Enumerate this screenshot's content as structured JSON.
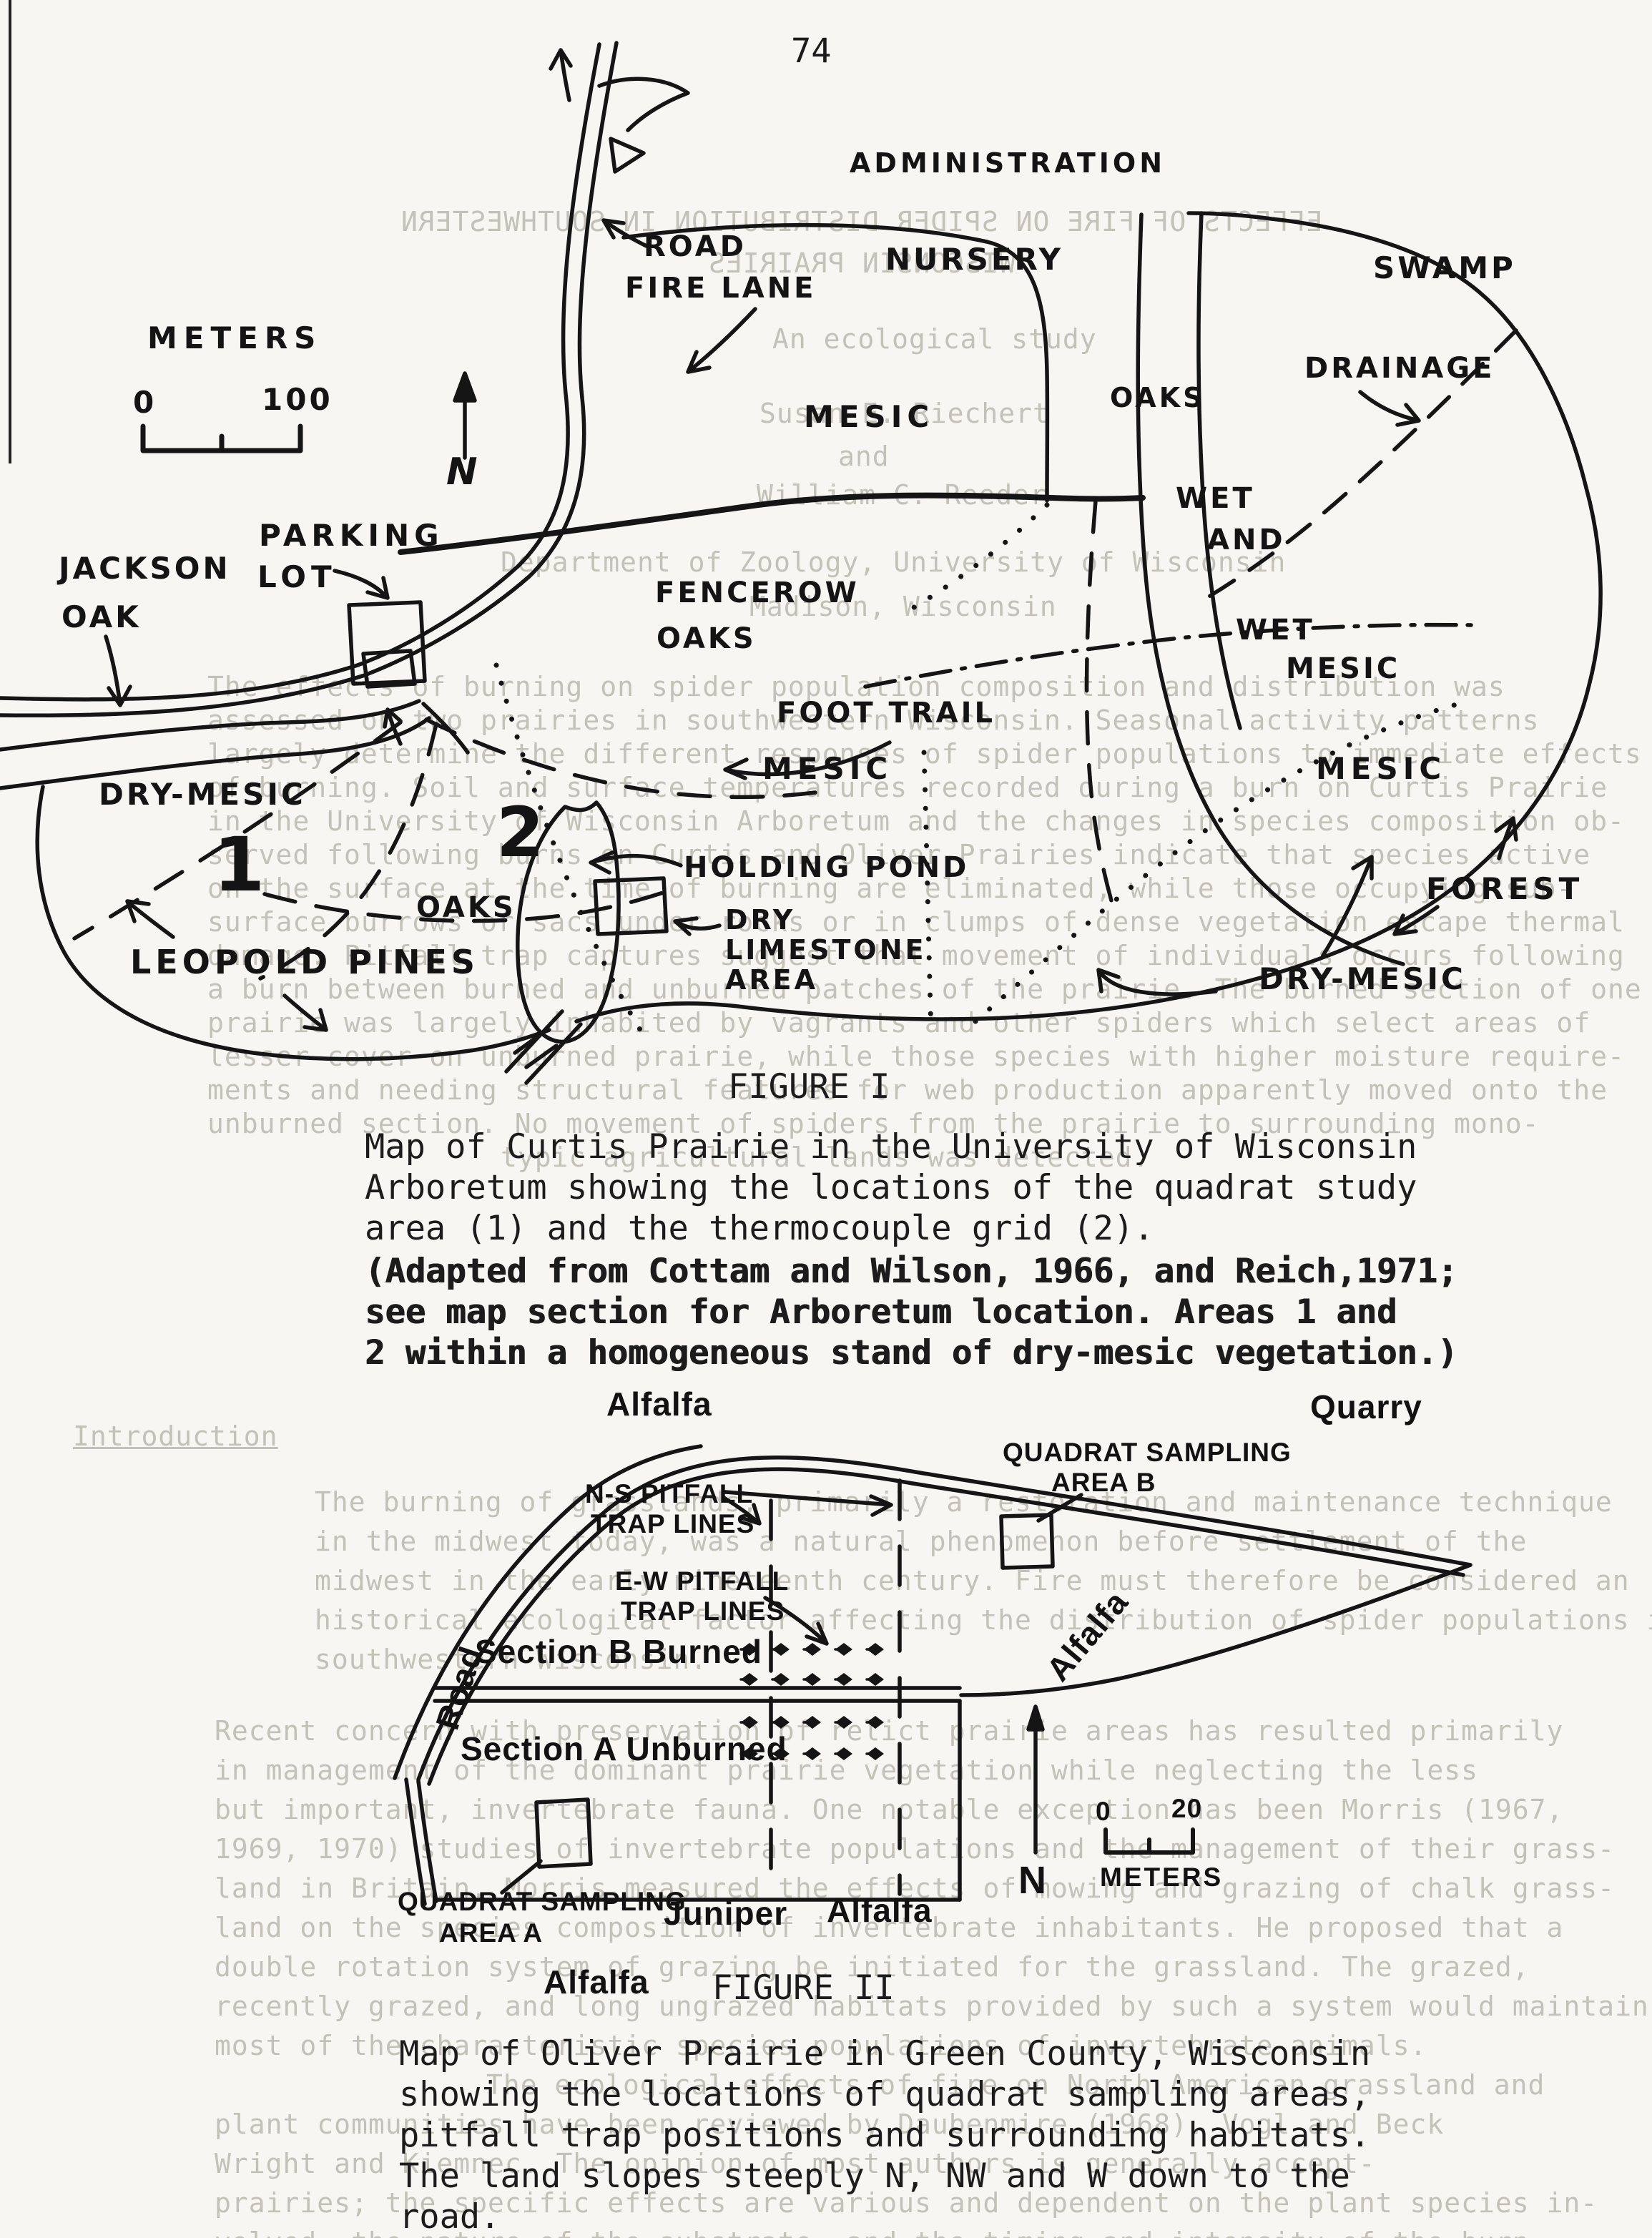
{
  "page": {
    "number": "74"
  },
  "figure1": {
    "heading": "FIGURE I",
    "caption": [
      "Map of Curtis Prairie in the University of Wisconsin",
      "Arboretum showing the locations of the quadrat study",
      "area (1) and the thermocouple grid (2)."
    ],
    "caption_adapted": [
      "(Adapted from Cottam and Wilson, 1966, and Reich,1971;",
      "see map section for Arboretum location. Areas 1 and",
      "2 within a homogeneous stand of dry-mesic vegetation.)"
    ],
    "scale": {
      "title": "METERS",
      "zero": "0",
      "hundred": "100"
    },
    "north": "N",
    "labels": {
      "road": "ROAD",
      "fire_lane": "FIRE LANE",
      "administration": "ADMINISTRATION",
      "nursery": "NURSERY",
      "swamp": "SWAMP",
      "drainage": "DRAINAGE",
      "oaks_top": "OAKS",
      "mesic_top": "MESIC",
      "wet1": "WET",
      "and": "AND",
      "wet2": "WET",
      "mesic_wet": "MESIC",
      "jackson": "JACKSON",
      "jackson_oak": "OAK",
      "parking": "PARKING",
      "parking_lot": "LOT",
      "fencerow": "FENCEROW",
      "fencerow_oaks": "OAKS",
      "foot_trail": "FOOT TRAIL",
      "dry_mesic_left": "DRY-MESIC",
      "area1": "1",
      "area2": "2",
      "mesic_center": "MESIC",
      "mesic_right": "MESIC",
      "holding_pond": "HOLDING POND",
      "oaks_center": "OAKS",
      "dry": "DRY",
      "limestone": "LIMESTONE",
      "area_word": "AREA",
      "leopold_pines": "LEOPOLD PINES",
      "forest": "FOREST",
      "dry_mesic_right": "DRY-MESIC"
    }
  },
  "figure2": {
    "heading": "FIGURE II",
    "caption": [
      "Map of Oliver Prairie in Green County, Wisconsin",
      "showing the locations of quadrat sampling areas,",
      "pitfall trap positions and surrounding habitats.",
      "The land slopes steeply N, NW and W down to the",
      "road."
    ],
    "scale": {
      "zero": "0",
      "twenty": "20",
      "units": "METERS"
    },
    "north": "N",
    "labels": {
      "alfalfa_top": "Alfalfa",
      "quarry": "Quarry",
      "quadrat_b1": "QUADRAT SAMPLING",
      "quadrat_b2": "AREA B",
      "ns_pitfall1": "N-S PITFALL",
      "ns_pitfall2": "TRAP LINES",
      "ew_pitfall1": "E-W PITFALL",
      "ew_pitfall2": "TRAP LINES",
      "road": "Road",
      "section_b": "Section B Burned",
      "section_a": "Section A Unburned",
      "alfalfa_right": "Alfalfa",
      "quadrat_a1": "QUADRAT SAMPLING",
      "quadrat_a2": "AREA A",
      "juniper": "Juniper",
      "alfalfa_mid": "Alfalfa",
      "alfalfa_bottom": "Alfalfa"
    }
  },
  "bleed": {
    "lines": [
      "EFFECTS OF FIRE ON SPIDER DISTRIBUTION IN SOUTHWESTERN",
      "WISCONSIN PRAIRIES",
      "An ecological study",
      "Susan E. Riechert",
      "and",
      "William C. Reeder",
      "Department of Zoology, University of Wisconsin",
      "Madison, Wisconsin",
      "The effects of burning on spider population composition and distribution was",
      "assessed on two prairies in southwestern Wisconsin. Seasonal activity patterns",
      "largely determine the different responses of spider populations to immediate effects",
      "of burning. Soil and surface temperatures recorded during a burn on Curtis Prairie",
      "in the University of Wisconsin Arboretum and the changes in species composition ob-",
      "served following burns on Curtis and Oliver Prairies indicate that species active",
      "on the surface at the time of burning are eliminated, while those occupying sub-",
      "surface burrows or sacs under rocks or in clumps of dense vegetation escape thermal",
      "damage. Pitfall trap captures suggest that movement of individuals occurs following",
      "a burn between burned and unburned patches of the prairie. The burned section of one",
      "prairie was largely inhabited by vagrants and other spiders which select areas of",
      "lesser cover on unburned prairie, while those species with higher moisture require-",
      "ments and needing structural features for web production apparently moved onto the",
      "unburned section. No movement of spiders from the prairie to surrounding mono-",
      "typic agricultural lands was detected.",
      "Introduction",
      "The burning of grasslands, primarily a restoration and maintenance technique",
      "in the midwest today, was a natural phenomenon before settlement of the",
      "midwest in the early nineteenth century. Fire must therefore be considered an",
      "historical ecological factor affecting the distribution of spider populations in",
      "southwestern Wisconsin.",
      "Recent concern with preservation of relict prairie areas has resulted primarily",
      "in management of the dominant prairie vegetation while neglecting the less",
      "but important, invertebrate fauna. One notable exception has been Morris (1967,",
      "1969, 1970) studies of invertebrate populations and the management of their grass-",
      "land in Britain. Morris measured the effects of mowing and grazing of chalk grass-",
      "land on the species composition of invertebrate inhabitants. He proposed that a",
      "double rotation system of grazing be initiated for the grassland. The grazed,",
      "recently grazed, and long ungrazed habitats provided by such a system would maintain",
      "most of the characteristic species populations of invertebrate animals.",
      "The ecological effects of fire on North American grassland and",
      "plant communities have been reviewed by Daubenmire (1968). Vogl and Beck",
      "Wright and Kiemnec. The opinion of most authors is generally accept-",
      "prairies; the specific effects are various and dependent on the plant species in-",
      "volved, the nature of the substrate, and the timing and intensity of the burn."
    ]
  }
}
